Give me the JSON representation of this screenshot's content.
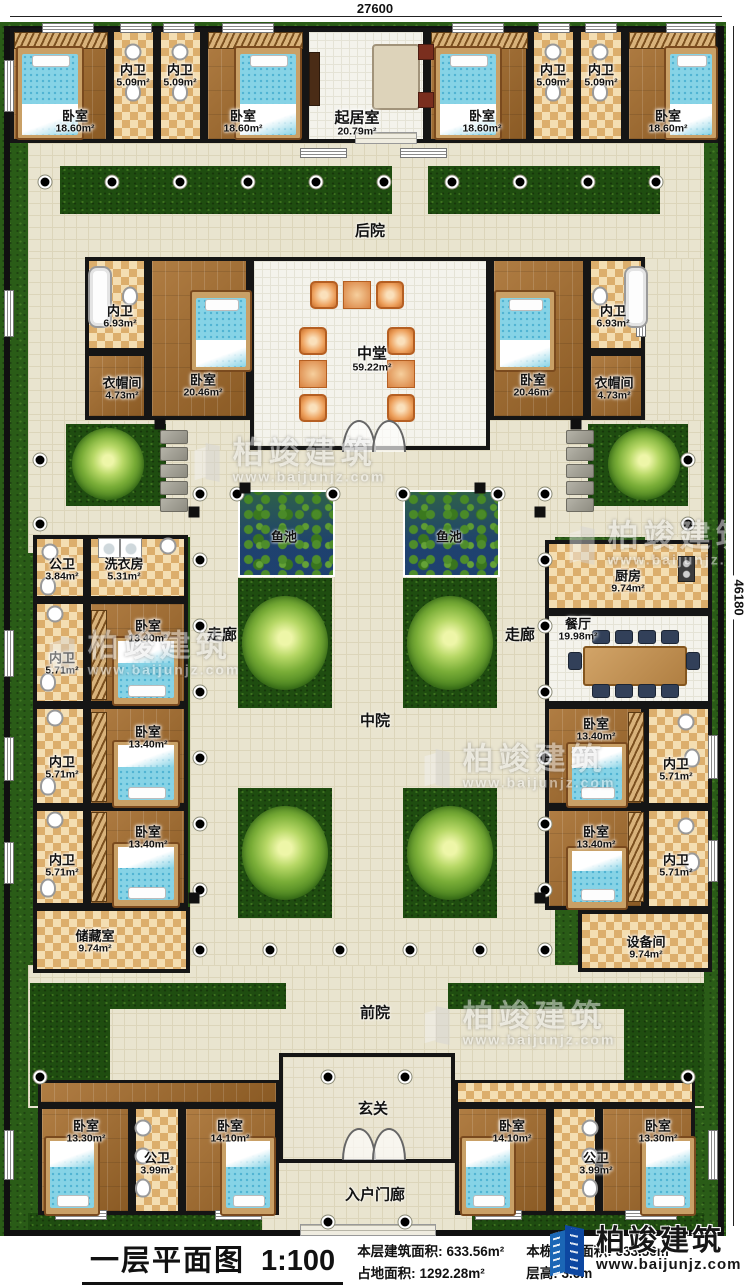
{
  "dimensions": {
    "top": "27600",
    "right": "46180"
  },
  "watermark": {
    "brand": "柏竣建筑",
    "url": "www.baijunjz.com"
  },
  "title_block": {
    "plan_name": "一层平面图",
    "scale": "1:100",
    "floor_area_label": "本层建筑面积:",
    "floor_area_value": "633.56m²",
    "site_area_label": "占地面积:",
    "site_area_value": "1292.28m²",
    "building_area_label": "本栋建筑面积:",
    "building_area_value": "633.56m²",
    "height_label": "层高:",
    "height_value": "3.6m"
  },
  "areas": {
    "backyard": "后院",
    "corridor": "走廊",
    "middle_courtyard": "中院",
    "front_yard": "前院",
    "entrance_hall": "玄关",
    "entry_porch": "入户门廊",
    "fish_pond": "鱼池"
  },
  "rooms": [
    {
      "label": "卧室",
      "area": "18.60m²"
    },
    {
      "label": "内卫",
      "area": "5.09m²"
    },
    {
      "label": "内卫",
      "area": "5.09m²"
    },
    {
      "label": "卧室",
      "area": "18.60m²"
    },
    {
      "label": "起居室",
      "area": "20.79m²"
    },
    {
      "label": "卧室",
      "area": "18.60m²"
    },
    {
      "label": "内卫",
      "area": "5.09m²"
    },
    {
      "label": "内卫",
      "area": "5.09m²"
    },
    {
      "label": "卧室",
      "area": "18.60m²"
    },
    {
      "label": "内卫",
      "area": "6.93m²"
    },
    {
      "label": "衣帽间",
      "area": "4.73m²"
    },
    {
      "label": "卧室",
      "area": "20.46m²"
    },
    {
      "label": "中堂",
      "area": "59.22m²"
    },
    {
      "label": "卧室",
      "area": "20.46m²"
    },
    {
      "label": "内卫",
      "area": "6.93m²"
    },
    {
      "label": "衣帽间",
      "area": "4.73m²"
    },
    {
      "label": "公卫",
      "area": "3.84m²"
    },
    {
      "label": "洗衣房",
      "area": "5.31m²"
    },
    {
      "label": "卧室",
      "area": "13.40m²"
    },
    {
      "label": "内卫",
      "area": "5.71m²"
    },
    {
      "label": "卧室",
      "area": "13.40m²"
    },
    {
      "label": "内卫",
      "area": "5.71m²"
    },
    {
      "label": "卧室",
      "area": "13.40m²"
    },
    {
      "label": "内卫",
      "area": "5.71m²"
    },
    {
      "label": "储藏室",
      "area": "9.74m²"
    },
    {
      "label": "厨房",
      "area": "9.74m²"
    },
    {
      "label": "餐厅",
      "area": "19.98m²"
    },
    {
      "label": "卧室",
      "area": "13.40m²"
    },
    {
      "label": "内卫",
      "area": "5.71m²"
    },
    {
      "label": "卧室",
      "area": "13.40m²"
    },
    {
      "label": "内卫",
      "area": "5.71m²"
    },
    {
      "label": "设备间",
      "area": "9.74m²"
    },
    {
      "label": "卧室",
      "area": "13.30m²"
    },
    {
      "label": "公卫",
      "area": "3.99m²"
    },
    {
      "label": "卧室",
      "area": "14.10m²"
    },
    {
      "label": "卧室",
      "area": "14.10m²"
    },
    {
      "label": "公卫",
      "area": "3.99m²"
    },
    {
      "label": "卧室",
      "area": "13.30m²"
    }
  ]
}
